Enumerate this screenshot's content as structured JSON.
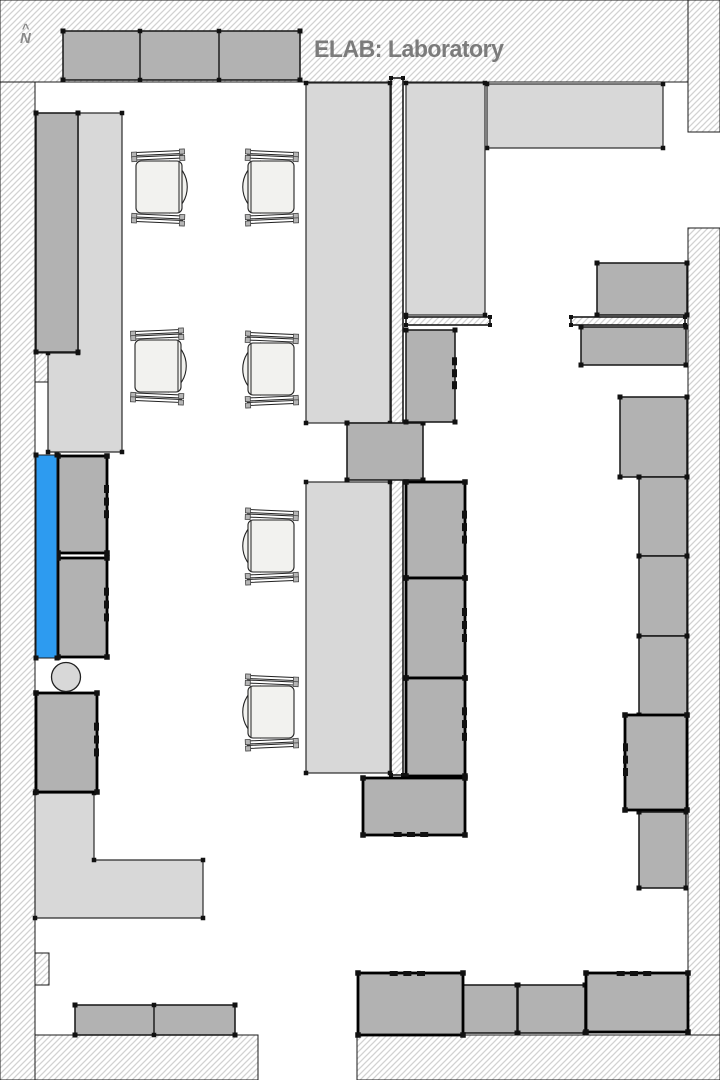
{
  "meta": {
    "title": "ELAB: Laboratory",
    "north_label": "N",
    "north_caret": "^",
    "canvas": {
      "width": 720,
      "height": 1080
    }
  },
  "colors": {
    "background": "#ffffff",
    "hatch_line": "#d2d2d2",
    "wall_stroke": "#1a1a1a",
    "bench_fill": "#d8d8d8",
    "bench_stroke": "#2a2a2a",
    "cabinet_fill": "#b2b2b2",
    "cabinet_stroke": "#141414",
    "equipment_stroke": "#000000",
    "selected_fill": "#2d9bf0",
    "chair_fill": "#f2f2ef",
    "chair_stroke": "#222222",
    "dot_fill": "#111111",
    "title_color": "#7b7b7b",
    "north_color": "#8a8a8a"
  },
  "walls": [
    {
      "id": "wall-left",
      "shape": "rect",
      "x": 0,
      "y": 0,
      "w": 35,
      "h": 1080
    },
    {
      "id": "wall-top",
      "shape": "rect",
      "x": 0,
      "y": 0,
      "w": 688,
      "h": 82
    },
    {
      "id": "wall-top-right-stub",
      "shape": "rect",
      "x": 688,
      "y": 0,
      "w": 32,
      "h": 132
    },
    {
      "id": "wall-right",
      "shape": "rect",
      "x": 688,
      "y": 228,
      "w": 32,
      "h": 852
    },
    {
      "id": "wall-bottom-left",
      "shape": "rect",
      "x": 35,
      "y": 1035,
      "w": 223,
      "h": 45
    },
    {
      "id": "wall-bottom-right",
      "shape": "rect",
      "x": 357,
      "y": 1035,
      "w": 363,
      "h": 45
    },
    {
      "id": "wall-pilaster-left",
      "shape": "rect",
      "x": 35,
      "y": 353,
      "w": 13,
      "h": 29
    },
    {
      "id": "wall-notch-left",
      "shape": "rect",
      "x": 35,
      "y": 953,
      "w": 14,
      "h": 32
    }
  ],
  "partitions": [
    {
      "id": "partition-center",
      "shape": "rect",
      "x": 391,
      "y": 78,
      "w": 12,
      "h": 697
    },
    {
      "id": "ledge-center",
      "shape": "rect",
      "x": 406,
      "y": 317,
      "w": 84,
      "h": 8
    },
    {
      "id": "ledge-right",
      "shape": "rect",
      "x": 571,
      "y": 317,
      "w": 114,
      "h": 8
    }
  ],
  "benches": [
    {
      "id": "bench-top-right",
      "shape": "rect",
      "x": 487,
      "y": 84,
      "w": 176,
      "h": 64
    },
    {
      "id": "bench-center-upper",
      "shape": "rect",
      "x": 306,
      "y": 83,
      "w": 84,
      "h": 340
    },
    {
      "id": "bench-center-lower",
      "shape": "rect",
      "x": 306,
      "y": 482,
      "w": 84,
      "h": 291
    },
    {
      "id": "bench-center-east",
      "shape": "rect",
      "x": 406,
      "y": 83,
      "w": 79,
      "h": 232
    },
    {
      "id": "bench-left",
      "shape": "polygon",
      "points": [
        [
          78,
          113
        ],
        [
          122,
          113
        ],
        [
          122,
          452
        ],
        [
          48,
          452
        ],
        [
          48,
          353
        ],
        [
          78,
          353
        ]
      ]
    },
    {
      "id": "bench-bottom-left-L",
      "shape": "polygon",
      "points": [
        [
          35,
          793
        ],
        [
          94,
          793
        ],
        [
          94,
          860
        ],
        [
          203,
          860
        ],
        [
          203,
          918
        ],
        [
          35,
          918
        ]
      ]
    }
  ],
  "cabinets": [
    {
      "id": "cabinet-top-row",
      "shape": "rect",
      "x": 63,
      "y": 31,
      "w": 237,
      "h": 49,
      "dividers_x": [
        140,
        219
      ]
    },
    {
      "id": "cabinet-left-tall",
      "shape": "rect",
      "x": 36,
      "y": 113,
      "w": 42,
      "h": 239
    },
    {
      "id": "cabinet-center-mid",
      "shape": "rect",
      "x": 347,
      "y": 423,
      "w": 76,
      "h": 57
    },
    {
      "id": "cabinet-center-upper",
      "shape": "rect",
      "x": 406,
      "y": 330,
      "w": 49,
      "h": 92,
      "ticks": "right"
    },
    {
      "id": "cabinet-right-1",
      "shape": "rect",
      "x": 597,
      "y": 263,
      "w": 90,
      "h": 52
    },
    {
      "id": "cabinet-right-2",
      "shape": "rect",
      "x": 581,
      "y": 327,
      "w": 105,
      "h": 38
    },
    {
      "id": "cabinet-right-3",
      "shape": "rect",
      "x": 620,
      "y": 397,
      "w": 67,
      "h": 80
    },
    {
      "id": "cabinet-right-col-1",
      "shape": "rect",
      "x": 639,
      "y": 477,
      "w": 48,
      "h": 79
    },
    {
      "id": "cabinet-right-col-2",
      "shape": "rect",
      "x": 639,
      "y": 556,
      "w": 48,
      "h": 80
    },
    {
      "id": "cabinet-right-col-3",
      "shape": "rect",
      "x": 639,
      "y": 636,
      "w": 48,
      "h": 79
    },
    {
      "id": "cabinet-right-low",
      "shape": "rect",
      "x": 639,
      "y": 812,
      "w": 47,
      "h": 76
    },
    {
      "id": "cabinet-bottom-1",
      "shape": "rect",
      "x": 460,
      "y": 985,
      "w": 57,
      "h": 48
    },
    {
      "id": "cabinet-bottom-2",
      "shape": "rect",
      "x": 518,
      "y": 985,
      "w": 67,
      "h": 48
    },
    {
      "id": "cabinet-bottom-left",
      "shape": "rect",
      "x": 75,
      "y": 1005,
      "w": 160,
      "h": 30,
      "dividers_x": [
        154
      ]
    }
  ],
  "equipment": [
    {
      "id": "equip-left-1",
      "shape": "rect",
      "x": 58,
      "y": 456,
      "w": 49,
      "h": 97,
      "ticks": "right"
    },
    {
      "id": "equip-left-2",
      "shape": "rect",
      "x": 58,
      "y": 558,
      "w": 49,
      "h": 99,
      "ticks": "right"
    },
    {
      "id": "equip-left-3",
      "shape": "rect",
      "x": 36,
      "y": 693,
      "w": 61,
      "h": 99,
      "ticks": "right"
    },
    {
      "id": "equip-center-1",
      "shape": "rect",
      "x": 406,
      "y": 482,
      "w": 59,
      "h": 96,
      "ticks": "right"
    },
    {
      "id": "equip-center-2",
      "shape": "rect",
      "x": 406,
      "y": 578,
      "w": 59,
      "h": 100,
      "ticks": "right"
    },
    {
      "id": "equip-center-3",
      "shape": "rect",
      "x": 406,
      "y": 678,
      "w": 59,
      "h": 98,
      "ticks": "right"
    },
    {
      "id": "equip-center-bottom",
      "shape": "rect",
      "x": 363,
      "y": 778,
      "w": 102,
      "h": 57,
      "ticks": "bottom"
    },
    {
      "id": "equip-right",
      "shape": "rect",
      "x": 625,
      "y": 715,
      "w": 62,
      "h": 95,
      "ticks": "left"
    },
    {
      "id": "equip-bottom-row-1",
      "shape": "rect",
      "x": 358,
      "y": 973,
      "w": 105,
      "h": 62,
      "ticks": "top"
    },
    {
      "id": "equip-bottom-row-2",
      "shape": "rect",
      "x": 586,
      "y": 973,
      "w": 102,
      "h": 59,
      "ticks": "top"
    }
  ],
  "selected_element": {
    "id": "selected-bench-left",
    "shape": "rect",
    "x": 36,
    "y": 455,
    "w": 21,
    "h": 203
  },
  "fixtures": [
    {
      "id": "stool-circle",
      "shape": "circle",
      "cx": 66,
      "cy": 677,
      "r": 14.5
    }
  ],
  "chairs": [
    {
      "id": "chair-1",
      "x": 160,
      "y": 187,
      "facing": "right"
    },
    {
      "id": "chair-2",
      "x": 270,
      "y": 187,
      "facing": "left"
    },
    {
      "id": "chair-3",
      "x": 159,
      "y": 366,
      "facing": "right"
    },
    {
      "id": "chair-4",
      "x": 270,
      "y": 369,
      "facing": "left"
    },
    {
      "id": "chair-5",
      "x": 270,
      "y": 546,
      "facing": "left"
    },
    {
      "id": "chair-6",
      "x": 270,
      "y": 712,
      "facing": "left"
    }
  ]
}
